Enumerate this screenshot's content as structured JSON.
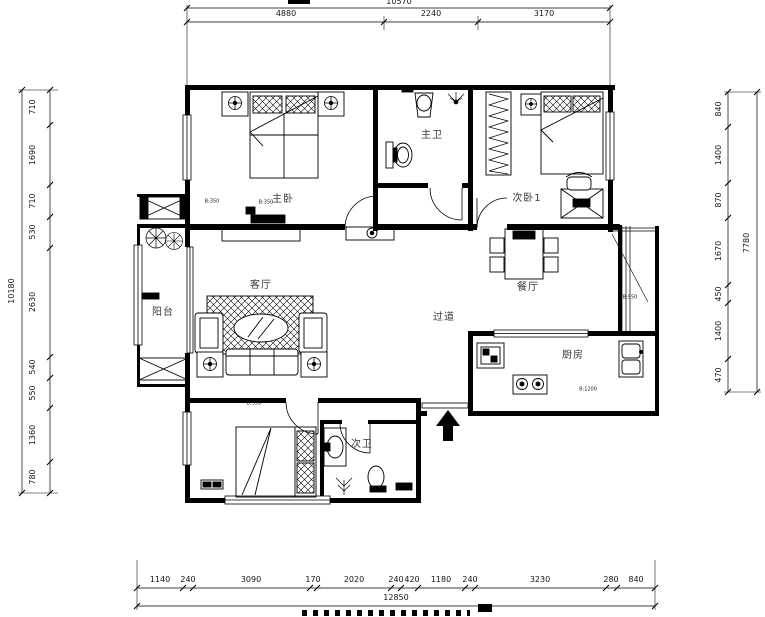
{
  "meta": {
    "background": "#ffffff",
    "ink": "#000000",
    "label_color": "#3a3a3a"
  },
  "rooms": {
    "master_bedroom": "主卧",
    "master_bath": "主卫",
    "bedroom2": "次卧1",
    "living_room": "客厅",
    "balcony": "阳台",
    "dining_room": "餐厅",
    "hallway": "过道",
    "kitchen": "厨房",
    "bath2": "次卫"
  },
  "dims": {
    "top": {
      "total": "10570",
      "seg": [
        "4880",
        "2240",
        "3170"
      ]
    },
    "bottom": {
      "total": "12850",
      "seg": [
        "1140",
        "240",
        "3090",
        "170",
        "2020",
        "240",
        "420",
        "1180",
        "240",
        "3230",
        "280",
        "840"
      ]
    },
    "left": {
      "total": "10180",
      "seg": [
        "710",
        "1690",
        "710",
        "530",
        "2630",
        "540",
        "550",
        "1360",
        "780"
      ]
    },
    "right": {
      "total": "7780",
      "seg": [
        "840",
        "1400",
        "870",
        "1670",
        "450",
        "1400",
        "470"
      ]
    }
  },
  "annotations": [
    "B:350",
    "B:350",
    "B:350",
    "B:550",
    "B:1200"
  ]
}
